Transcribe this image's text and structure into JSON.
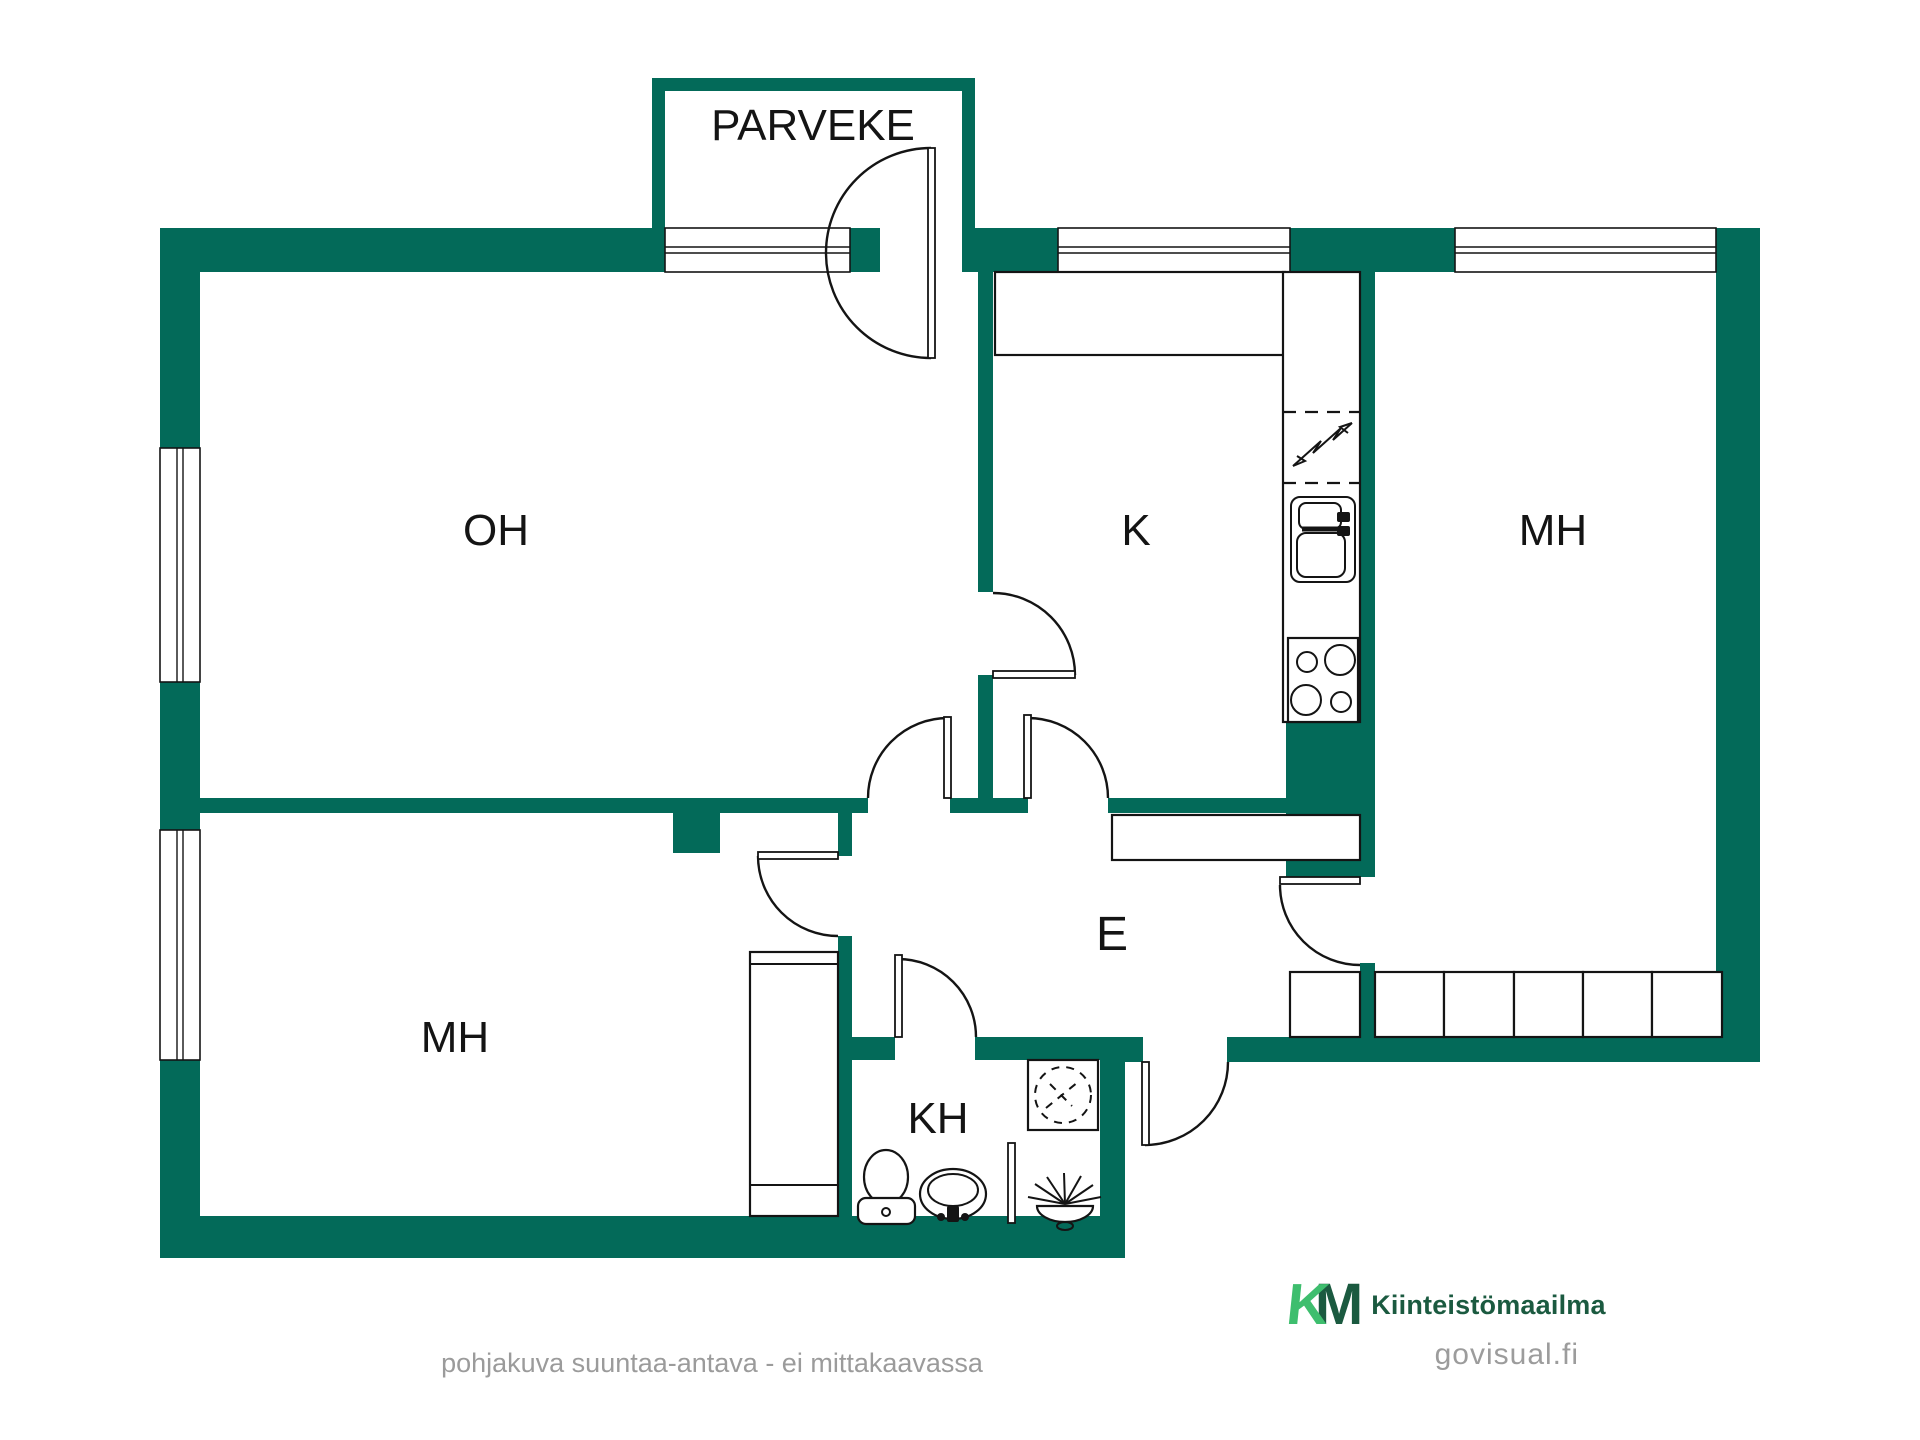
{
  "colors": {
    "wall_green": "#036a59",
    "line_black": "#141414",
    "logo_light_green": "#3ebe6e",
    "logo_dark_green": "#1b5a40",
    "muted_gray": "#9b9b9b"
  },
  "rooms": {
    "balcony": "PARVEKE",
    "living_room": "OH",
    "kitchen": "K",
    "bedroom_right": "MH",
    "bedroom_left": "MH",
    "hall": "E",
    "bathroom": "KH"
  },
  "footer": {
    "disclaimer": "pohjakuva suuntaa-antava - ei mittakaavassa"
  },
  "logo": {
    "mark_k": "K",
    "mark_m": "M",
    "brand": "Kiinteistömaailma",
    "watermark": "govisual.fi"
  }
}
